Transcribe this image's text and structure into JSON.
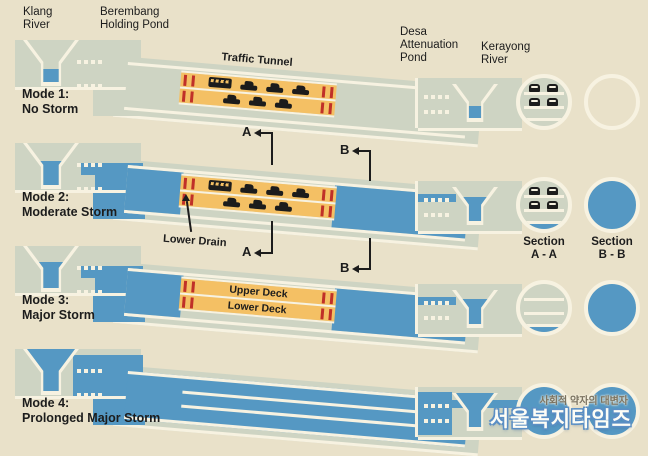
{
  "title": "Stormwater management and road tunnel operating modes",
  "colors": {
    "background": "#e9e1c9",
    "ground": "#ced4c3",
    "water": "#5598c3",
    "traffic_deck_orange": "#f4c064",
    "marker_red": "#c03028",
    "outline_white": "#f7f2e1",
    "text": "#1c1c1c",
    "watermark_blue": "#5b8fc5"
  },
  "landmarks": {
    "klang": [
      "Klang",
      "River"
    ],
    "berembang": [
      "Berembang",
      "Holding Pond"
    ],
    "desa": [
      "Desa",
      "Attenuation",
      "Pond"
    ],
    "kerayong": [
      "Kerayong",
      "River"
    ]
  },
  "modes": [
    {
      "title": "Mode 1:",
      "subtitle": "No Storm"
    },
    {
      "title": "Mode 2:",
      "subtitle": "Moderate Storm"
    },
    {
      "title": "Mode 3:",
      "subtitle": "Major Storm"
    },
    {
      "title": "Mode 4:",
      "subtitle": "Prolonged Major Storm"
    }
  ],
  "tunnel": {
    "traffic_label": "Traffic Tunnel",
    "upper_deck": "Upper Deck",
    "lower_deck": "Lower Deck",
    "lower_drain": "Lower Drain"
  },
  "section_markers": {
    "a": "A",
    "b": "B"
  },
  "section_labels": {
    "a": [
      "Section",
      "A - A"
    ],
    "b": [
      "Section",
      "B - B"
    ]
  },
  "watermark": {
    "tagline": "사회적 약자의 대변자",
    "name": "서울복지타임즈"
  }
}
